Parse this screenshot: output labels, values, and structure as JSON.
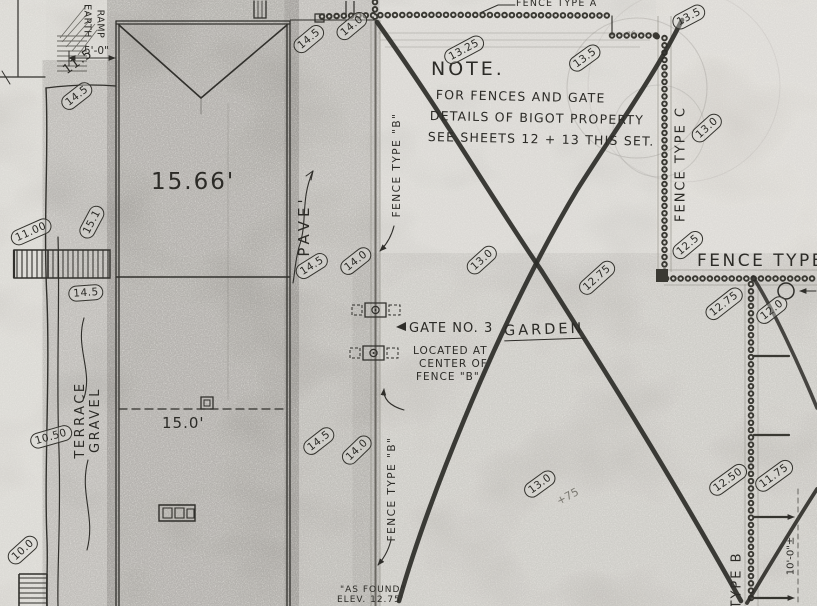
{
  "note": {
    "title": "NOTE.",
    "line1": "FOR FENCES AND GATE",
    "line2": "DETAILS OF BIGOT PROPERTY",
    "line3": "SEE SHEETS 12 + 13 THIS SET."
  },
  "labels": {
    "fence_type_a": "FENCE TYPE A",
    "fence_type_b_upper": "FENCE TYPE \"B\"",
    "fence_type_b_lower": "FENCE TYPE \"B\"",
    "fence_type_c": "FENCE TYPE C",
    "fence_type_right": "FENCE TYPE",
    "type_b_bottom": "TYPE B",
    "pave": "PAVE'",
    "terrace": "TERRACE",
    "gravel": "GRAVEL",
    "earth": "EARTH",
    "ramp": "RAMP",
    "garden": "GARDEN"
  },
  "gate_note": {
    "line1": "GATE NO. 3",
    "line2": "LOCATED AT",
    "line3": "CENTER OF",
    "line4": "FENCE \"B\""
  },
  "as_found": {
    "line1": "\"AS FOUND\"",
    "line2": "ELEV. 12.75'"
  },
  "dimensions": {
    "ramp": "5'-0\"",
    "roof": "15.66'",
    "bay": "15.0'",
    "offset": "10'-0\"±"
  },
  "pencil": {
    "p75": "+75",
    "p76": "76"
  },
  "elevations": [
    "11.5",
    "14.5",
    "11.00",
    "15.1",
    "14.5",
    "10.50",
    "10.0",
    "14.5",
    "14.0",
    "14.5",
    "14.0",
    "14.5",
    "14.0",
    "13.25",
    "13.5",
    "13.5",
    "13.0",
    "13.0",
    "12.75",
    "12.5",
    "12.75",
    "12.0",
    "13.0",
    "12.50",
    "11.75"
  ]
}
